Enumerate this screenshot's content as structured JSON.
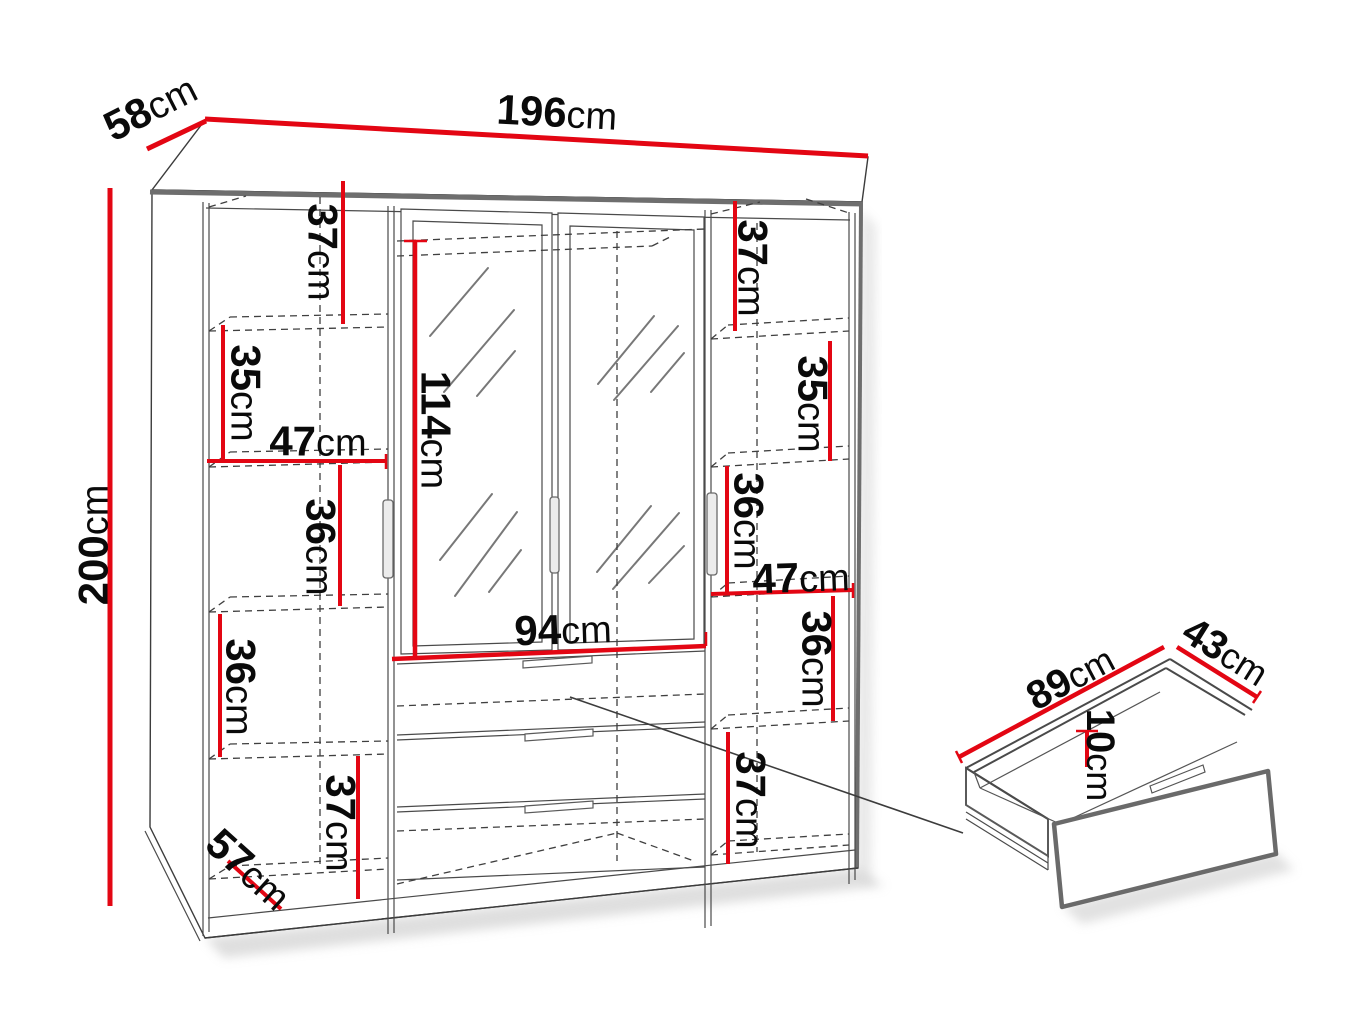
{
  "diagram": {
    "title": "Wardrobe dimension diagram",
    "unit": "cm",
    "accent_color": "#e30613",
    "line_color": "#3c3c3c",
    "background_color": "#ffffff"
  },
  "wardrobe": {
    "overall": {
      "width": {
        "value": "196",
        "unit": "cm"
      },
      "depth": {
        "value": "58",
        "unit": "cm"
      },
      "height": {
        "value": "200",
        "unit": "cm"
      }
    },
    "left_section": {
      "width": {
        "value": "47",
        "unit": "cm"
      },
      "top_shelf_height": {
        "value": "37",
        "unit": "cm"
      },
      "second_shelf_height": {
        "value": "35",
        "unit": "cm"
      },
      "middle_shelf_height": {
        "value": "36",
        "unit": "cm"
      },
      "lower_shelf_height": {
        "value": "36",
        "unit": "cm"
      },
      "bottom_shelf_height": {
        "value": "37",
        "unit": "cm"
      },
      "interior_depth": {
        "value": "57",
        "unit": "cm"
      }
    },
    "center_section": {
      "mirror_door_height": {
        "value": "114",
        "unit": "cm"
      },
      "width": {
        "value": "94",
        "unit": "cm"
      }
    },
    "right_section": {
      "width": {
        "value": "47",
        "unit": "cm"
      },
      "top_shelf_height": {
        "value": "37",
        "unit": "cm"
      },
      "second_shelf_height": {
        "value": "35",
        "unit": "cm"
      },
      "middle_shelf_height": {
        "value": "36",
        "unit": "cm"
      },
      "lower_shelf_height": {
        "value": "36",
        "unit": "cm"
      },
      "bottom_shelf_height": {
        "value": "37",
        "unit": "cm"
      }
    }
  },
  "drawer_detail": {
    "width": {
      "value": "89",
      "unit": "cm"
    },
    "depth": {
      "value": "43",
      "unit": "cm"
    },
    "height": {
      "value": "10",
      "unit": "cm"
    }
  }
}
